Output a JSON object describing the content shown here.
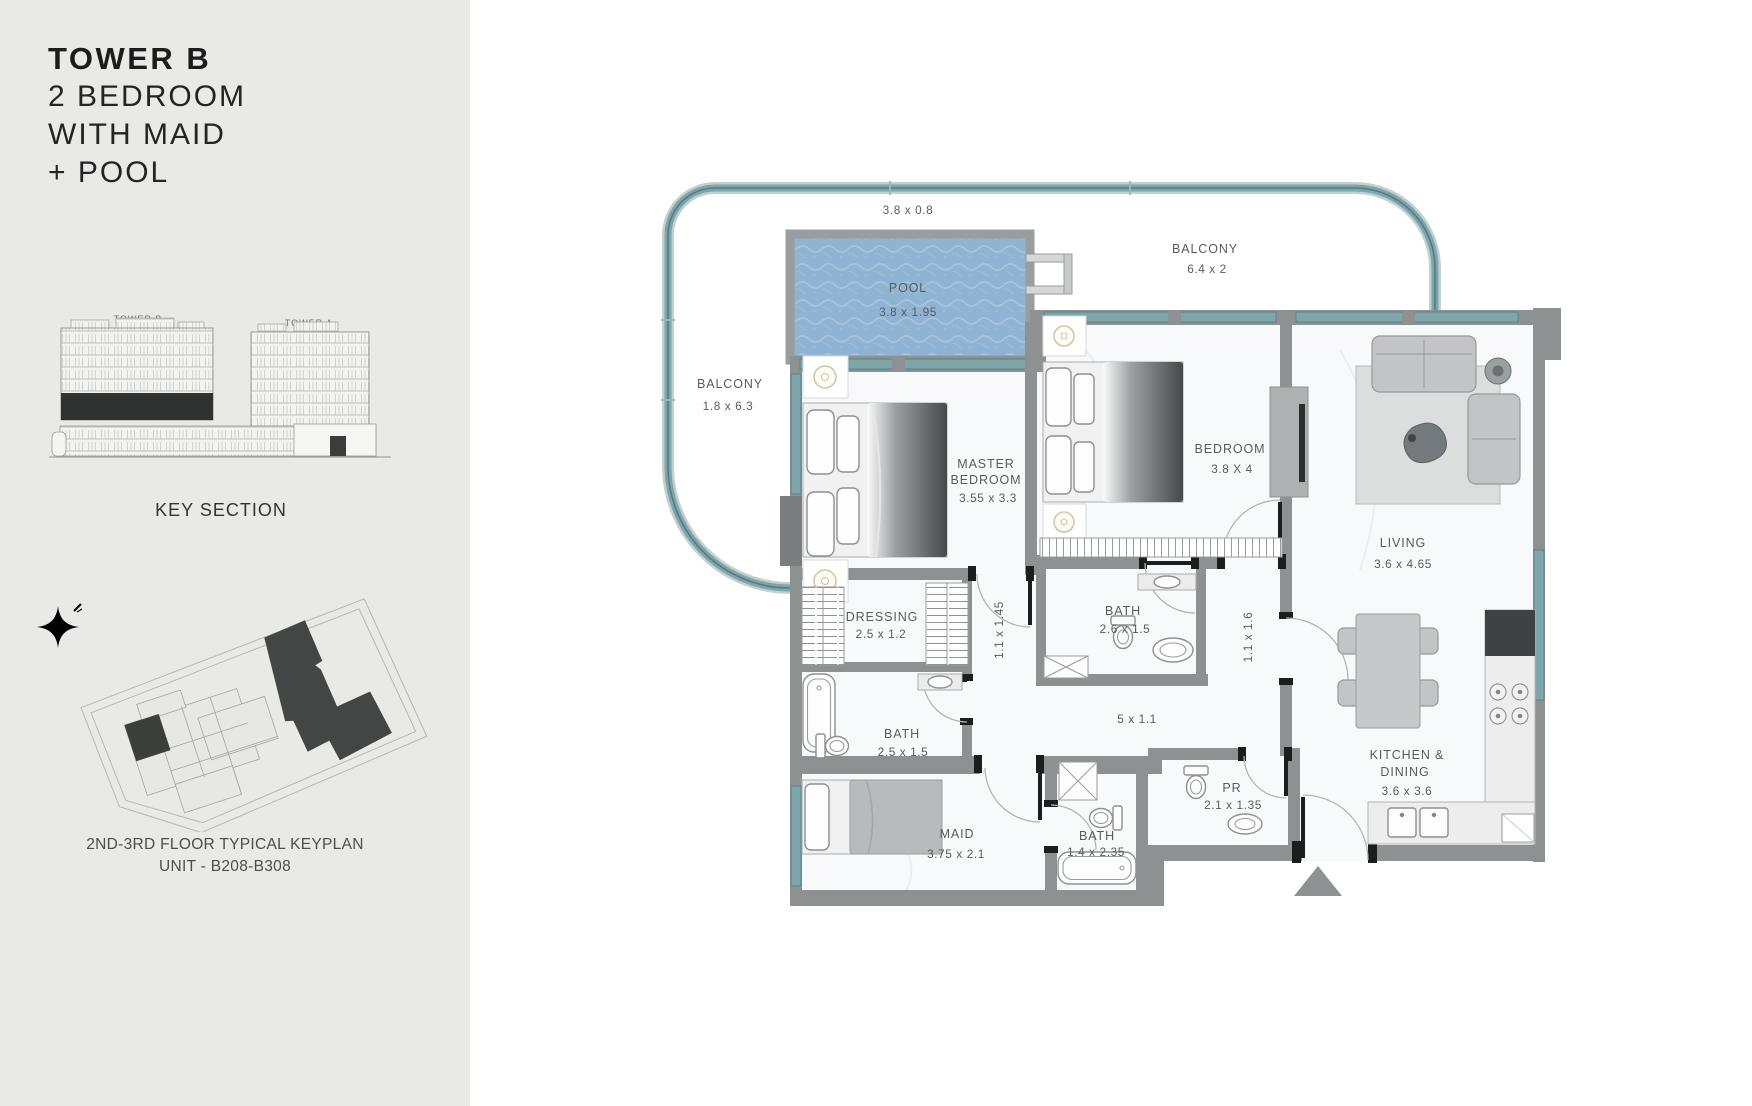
{
  "sidebar": {
    "title": {
      "line1": "TOWER B",
      "line2": "2 BEDROOM",
      "line3": "WITH MAID",
      "line4": "+ POOL"
    },
    "key_section": {
      "tower_left": "TOWER B",
      "tower_right": "TOWER A",
      "caption": "KEY SECTION"
    },
    "keyplan": {
      "caption_line1": "2ND-3RD FLOOR TYPICAL KEYPLAN",
      "caption_line2": "UNIT - B208-B308"
    }
  },
  "plan": {
    "balcony_top": {
      "dims": "3.8 x 0.8"
    },
    "pool": {
      "label": "POOL",
      "dims": "3.8 x 1.95"
    },
    "balcony_right": {
      "label": "BALCONY",
      "dims": "6.4 x 2"
    },
    "balcony_left": {
      "label": "BALCONY",
      "dims": "1.8 x 6.3"
    },
    "master_bedroom": {
      "label_line1": "MASTER",
      "label_line2": "BEDROOM",
      "dims": "3.55 x 3.3"
    },
    "bedroom": {
      "label": "BEDROOM",
      "dims": "3.8 X 4"
    },
    "living": {
      "label": "LIVING",
      "dims": "3.6 x  4.65"
    },
    "dressing": {
      "label": "DRESSING",
      "dims": "2.5 x 1.2"
    },
    "master_bath": {
      "label": "BATH",
      "dims": "2.5 x 1.5"
    },
    "bath": {
      "label": "BATH",
      "dims": "2.6 x 1.5"
    },
    "corridor_a": {
      "dims": "1.1 x 1.45"
    },
    "corridor_b": {
      "dims": "1.1 x 1.6"
    },
    "hallway": {
      "dims": "5 x 1.1"
    },
    "maid": {
      "label": "MAID",
      "dims": "3.75 x 2.1"
    },
    "maid_bath": {
      "label": "BATH",
      "dims": "1.4 x 2.35"
    },
    "powder_room": {
      "label": "PR",
      "dims": "2.1 x 1.35"
    },
    "kitchen": {
      "label_line1": "KITCHEN &",
      "label_line2": "DINING",
      "dims": "3.6 x 3.6"
    }
  },
  "colors": {
    "sidebar-bg": "#e9eae5",
    "ink": "#1a1c1d",
    "label": "#585c5e",
    "wall": "#8e9192",
    "teal": "#7da5aa",
    "teal-dark": "#517e86",
    "pool": "#8fb3d2",
    "floor": "#f8f9fa",
    "furn": "#c2c4c5",
    "dark": "#3f4244"
  }
}
